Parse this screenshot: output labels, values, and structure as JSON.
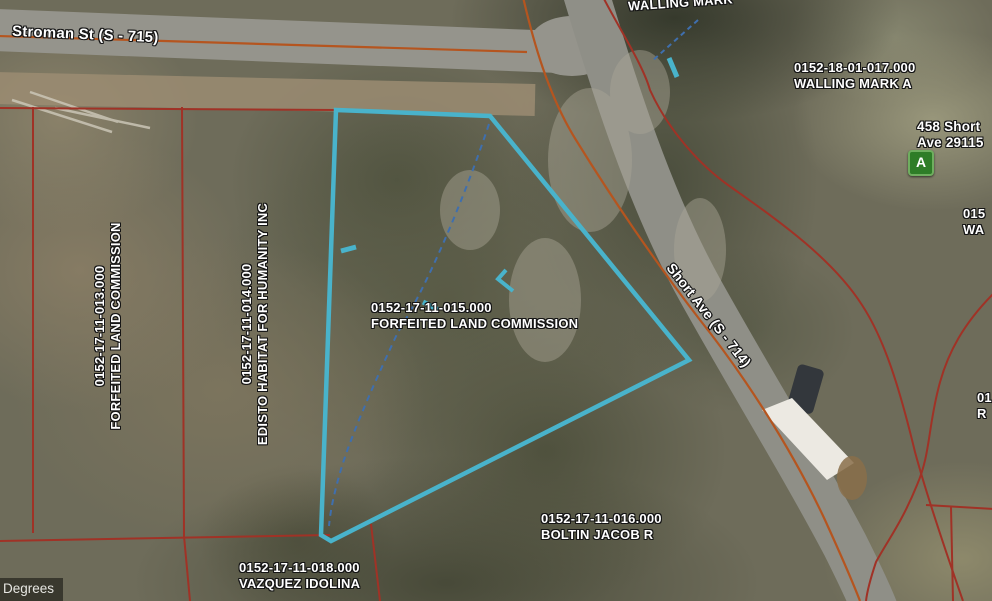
{
  "map": {
    "street_labels": {
      "stroman": "Stroman St (S - 715)",
      "short_ave": "Short Ave (S - 714)"
    },
    "parcel_labels": {
      "p013": {
        "id": "0152-17-11-013.000",
        "owner": "FORFEITED LAND COMMISSION"
      },
      "p014": {
        "id": "0152-17-11-014.000",
        "owner": "EDISTO HABITAT FOR HUMANITY INC"
      },
      "p015": {
        "id": "0152-17-11-015.000",
        "owner": "FORFEITED LAND COMMISSION"
      },
      "p016": {
        "id": "0152-17-11-016.000",
        "owner": "BOLTIN JACOB R"
      },
      "p018": {
        "id": "0152-17-11-018.000",
        "owner": "VAZQUEZ IDOLINA"
      },
      "p017": {
        "id": "0152-18-01-017.000",
        "owner": "WALLING MARK A"
      },
      "walling_top": {
        "owner": "WALLING MARK"
      },
      "edge_right_upper": {
        "id": "015",
        "owner": "WA"
      },
      "edge_right_lower": {
        "id": "01",
        "owner": "R"
      }
    },
    "address_marker": {
      "letter": "A",
      "line1": "458 Short",
      "line2": "Ave 29115"
    },
    "status_bar": {
      "units_label": "Degrees"
    },
    "colors": {
      "highlight_cyan": "#49b3cb",
      "survey_dash_blue": "#3f6fae",
      "road_line_orange": "#b5551f",
      "parcel_line_red": "#a03226",
      "marker_green": "#2e7d27"
    }
  }
}
